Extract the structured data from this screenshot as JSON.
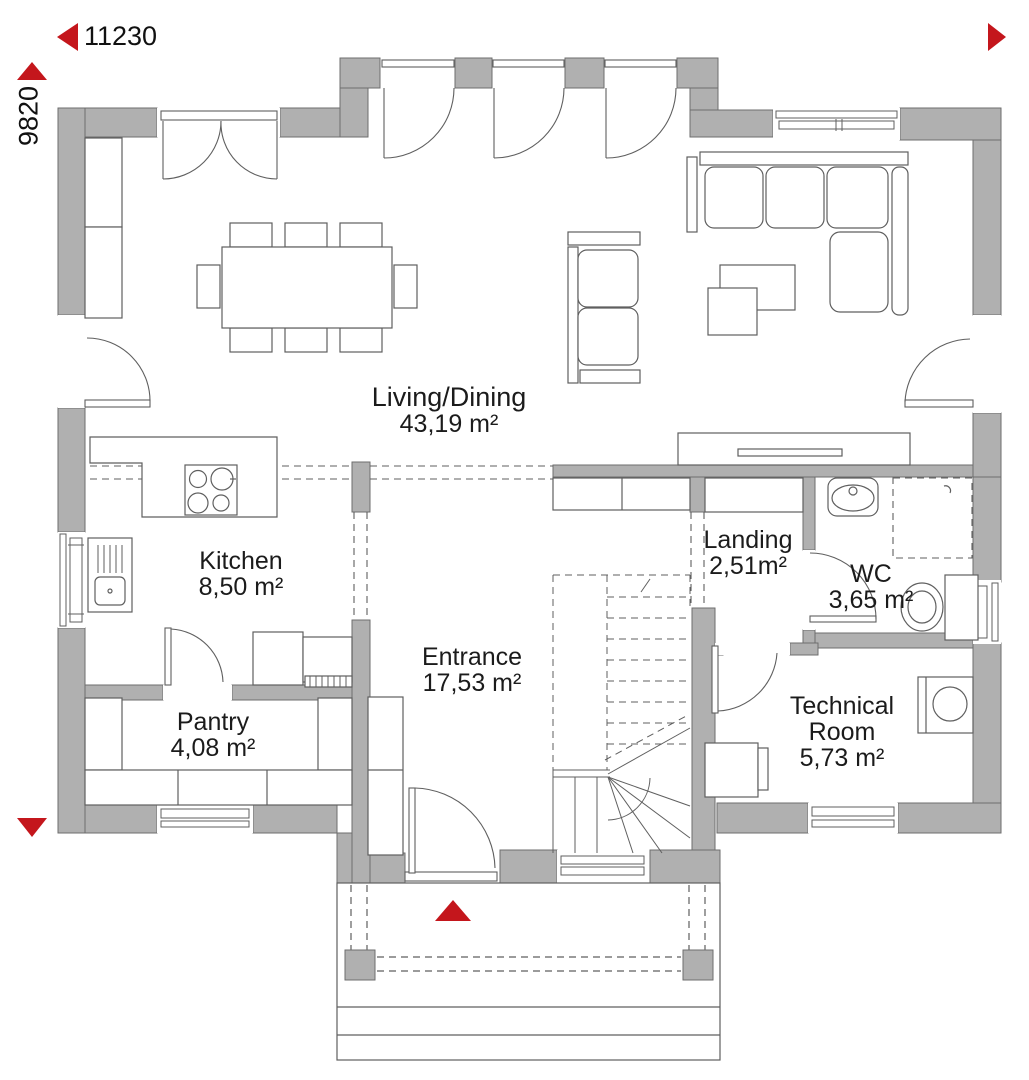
{
  "plan": {
    "title": "Ground floor plan",
    "dimensions": {
      "width_label": "11230",
      "height_label": "9820"
    },
    "rooms": [
      {
        "id": "living",
        "name": "Living/Dining",
        "area": "43,19 m²"
      },
      {
        "id": "kitchen",
        "name": "Kitchen",
        "area": "8,50 m²"
      },
      {
        "id": "pantry",
        "name": "Pantry",
        "area": "4,08 m²"
      },
      {
        "id": "entrance",
        "name": "Entrance",
        "area": "17,53 m²"
      },
      {
        "id": "landing",
        "name": "Landing",
        "area": "2,51m²"
      },
      {
        "id": "wc",
        "name": "WC",
        "area": "3,65 m²"
      },
      {
        "id": "technical",
        "name": "Technical Room",
        "area": "5,73 m²"
      }
    ],
    "colors": {
      "accent_red": "#c4161c",
      "wall_gray": "#b0b0b0",
      "line": "#5f5f5f"
    }
  }
}
